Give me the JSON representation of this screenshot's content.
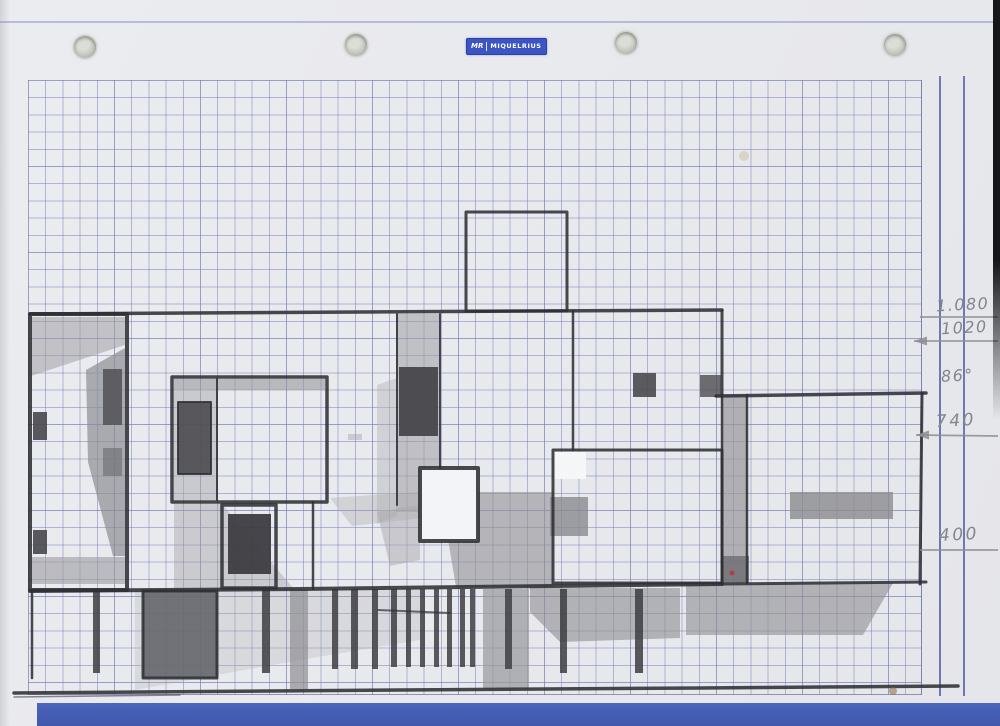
{
  "page": {
    "kind": "Scanned squared-paper notebook sheet with a hand-drawn pencil elevation sketch"
  },
  "brand": {
    "mark": "MR",
    "name": "MIQUELRIUS",
    "badge_color": "#3c55c2"
  },
  "paper": {
    "background": "#e9eaee",
    "grid_line_color": "#747eb2",
    "margin_rule_color": "#3e4e9e",
    "footer_band_color": "#4560b6",
    "hole_count": 4
  },
  "handwritten_dimensions": {
    "items": [
      {
        "label": "1.080"
      },
      {
        "label": "1020"
      },
      {
        "label": "86°"
      },
      {
        "label": "740"
      },
      {
        "label": "400"
      }
    ]
  },
  "sketch": {
    "medium": "graphite pencil",
    "subject": "modernist house front elevation with roof tower, ribbon windows and pilotis"
  }
}
